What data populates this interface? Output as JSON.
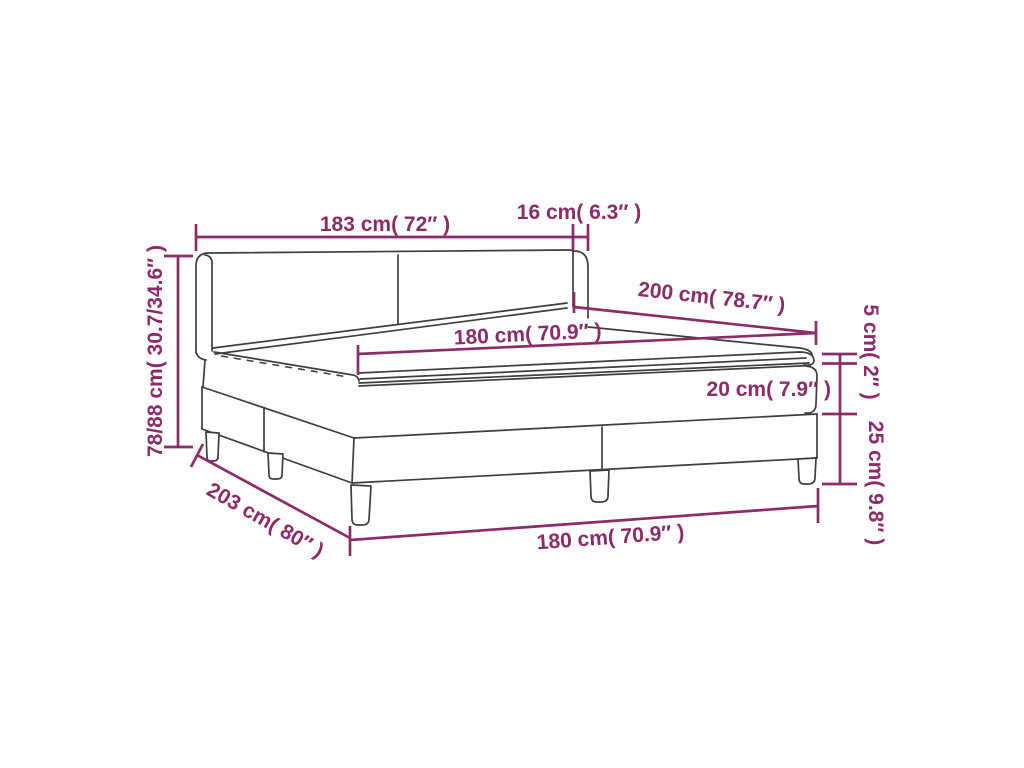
{
  "diagram": {
    "subject": "box-spring bed with headboard, mattress and topper - product dimension diagram",
    "colors": {
      "accent": "#8b2b68",
      "line": "#3e3e3e",
      "background": "#ffffff"
    },
    "dimensions": {
      "headboard_width": "183 cm( 72″ )",
      "headboard_wing_depth": "16 cm( 6.3″ )",
      "bed_length": "200 cm( 78.7″ )",
      "mattress_width": "180 cm( 70.9″ )",
      "mattress_thickness": "20 cm( 7.9″ )",
      "topper_thickness": "5 cm( 2″ )",
      "base_height": "25 cm( 9.8″ )",
      "headboard_height": "78/88 cm( 30.7/34.6″ )",
      "total_length": "203 cm( 80″ )",
      "base_width": "180 cm( 70.9″ )"
    }
  }
}
